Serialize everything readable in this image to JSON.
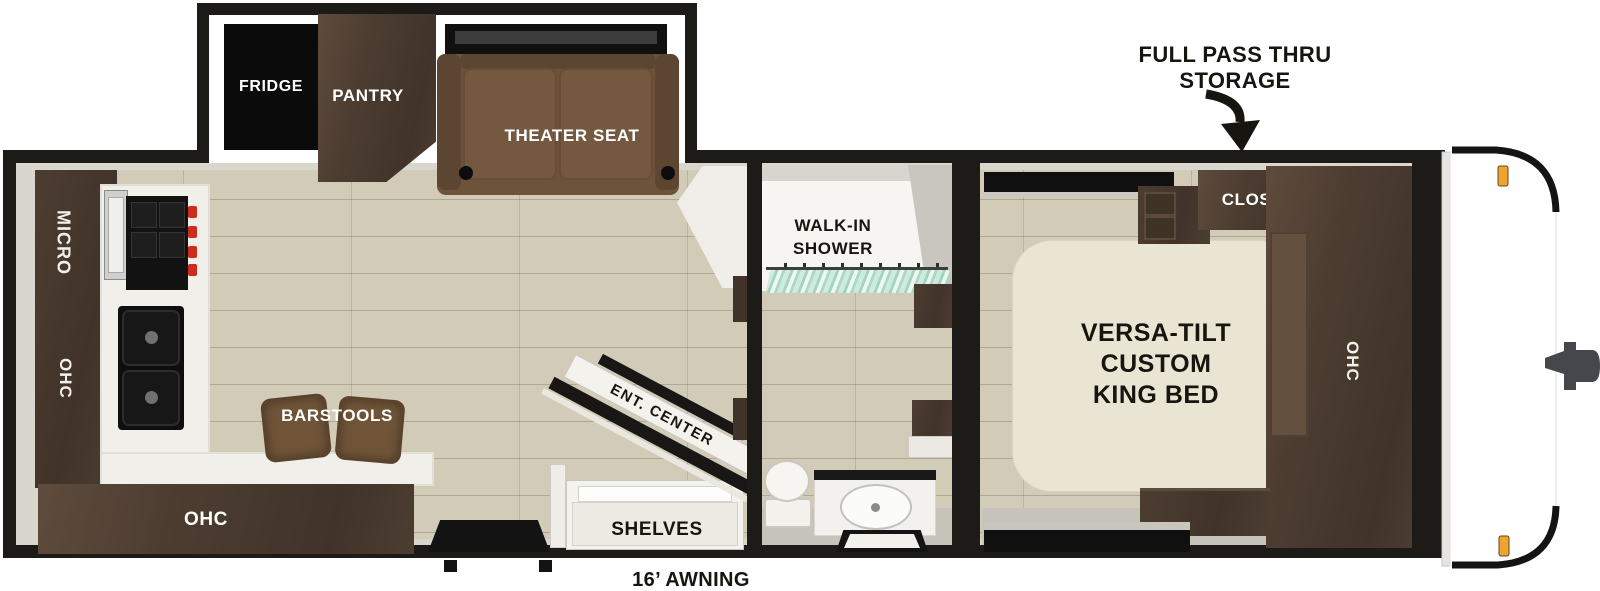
{
  "colors": {
    "wall": "#1d1b18",
    "wood": "#4d3d31",
    "wood_dark": "#41332a",
    "wood_light": "#5e4b3c",
    "seat": "#6d5339",
    "seat_dark": "#5c4531",
    "floor": "#d1cbb8",
    "counter": "#f1efe9",
    "bed": "#e9e5d2",
    "teal": "#9fd2c0",
    "orange": "#efa42f",
    "face": "#d9d6ce",
    "band": "#c6c3ba",
    "white": "#f6f5f1"
  },
  "exterior": {
    "storage_line1": "FULL PASS THRU",
    "storage_line2": "STORAGE",
    "awning": "16’ AWNING"
  },
  "slideout": {
    "fridge": "FRIDGE",
    "pantry": "PANTRY",
    "theater_seat": "THEATER SEAT"
  },
  "kitchen": {
    "micro": "MICRO",
    "ohc_wall": "OHC",
    "ohc_counter": "OHC",
    "barstools": "BARSTOOLS"
  },
  "living": {
    "ent_center": "ENT. CENTER",
    "shelves": "SHELVES"
  },
  "bathroom": {
    "shower_line1": "WALK-IN",
    "shower_line2": "SHOWER"
  },
  "bedroom": {
    "bed_line1": "VERSA-TILT",
    "bed_line2": "CUSTOM",
    "bed_line3": "KING BED",
    "closet": "CLOSET",
    "ohc": "OHC"
  }
}
